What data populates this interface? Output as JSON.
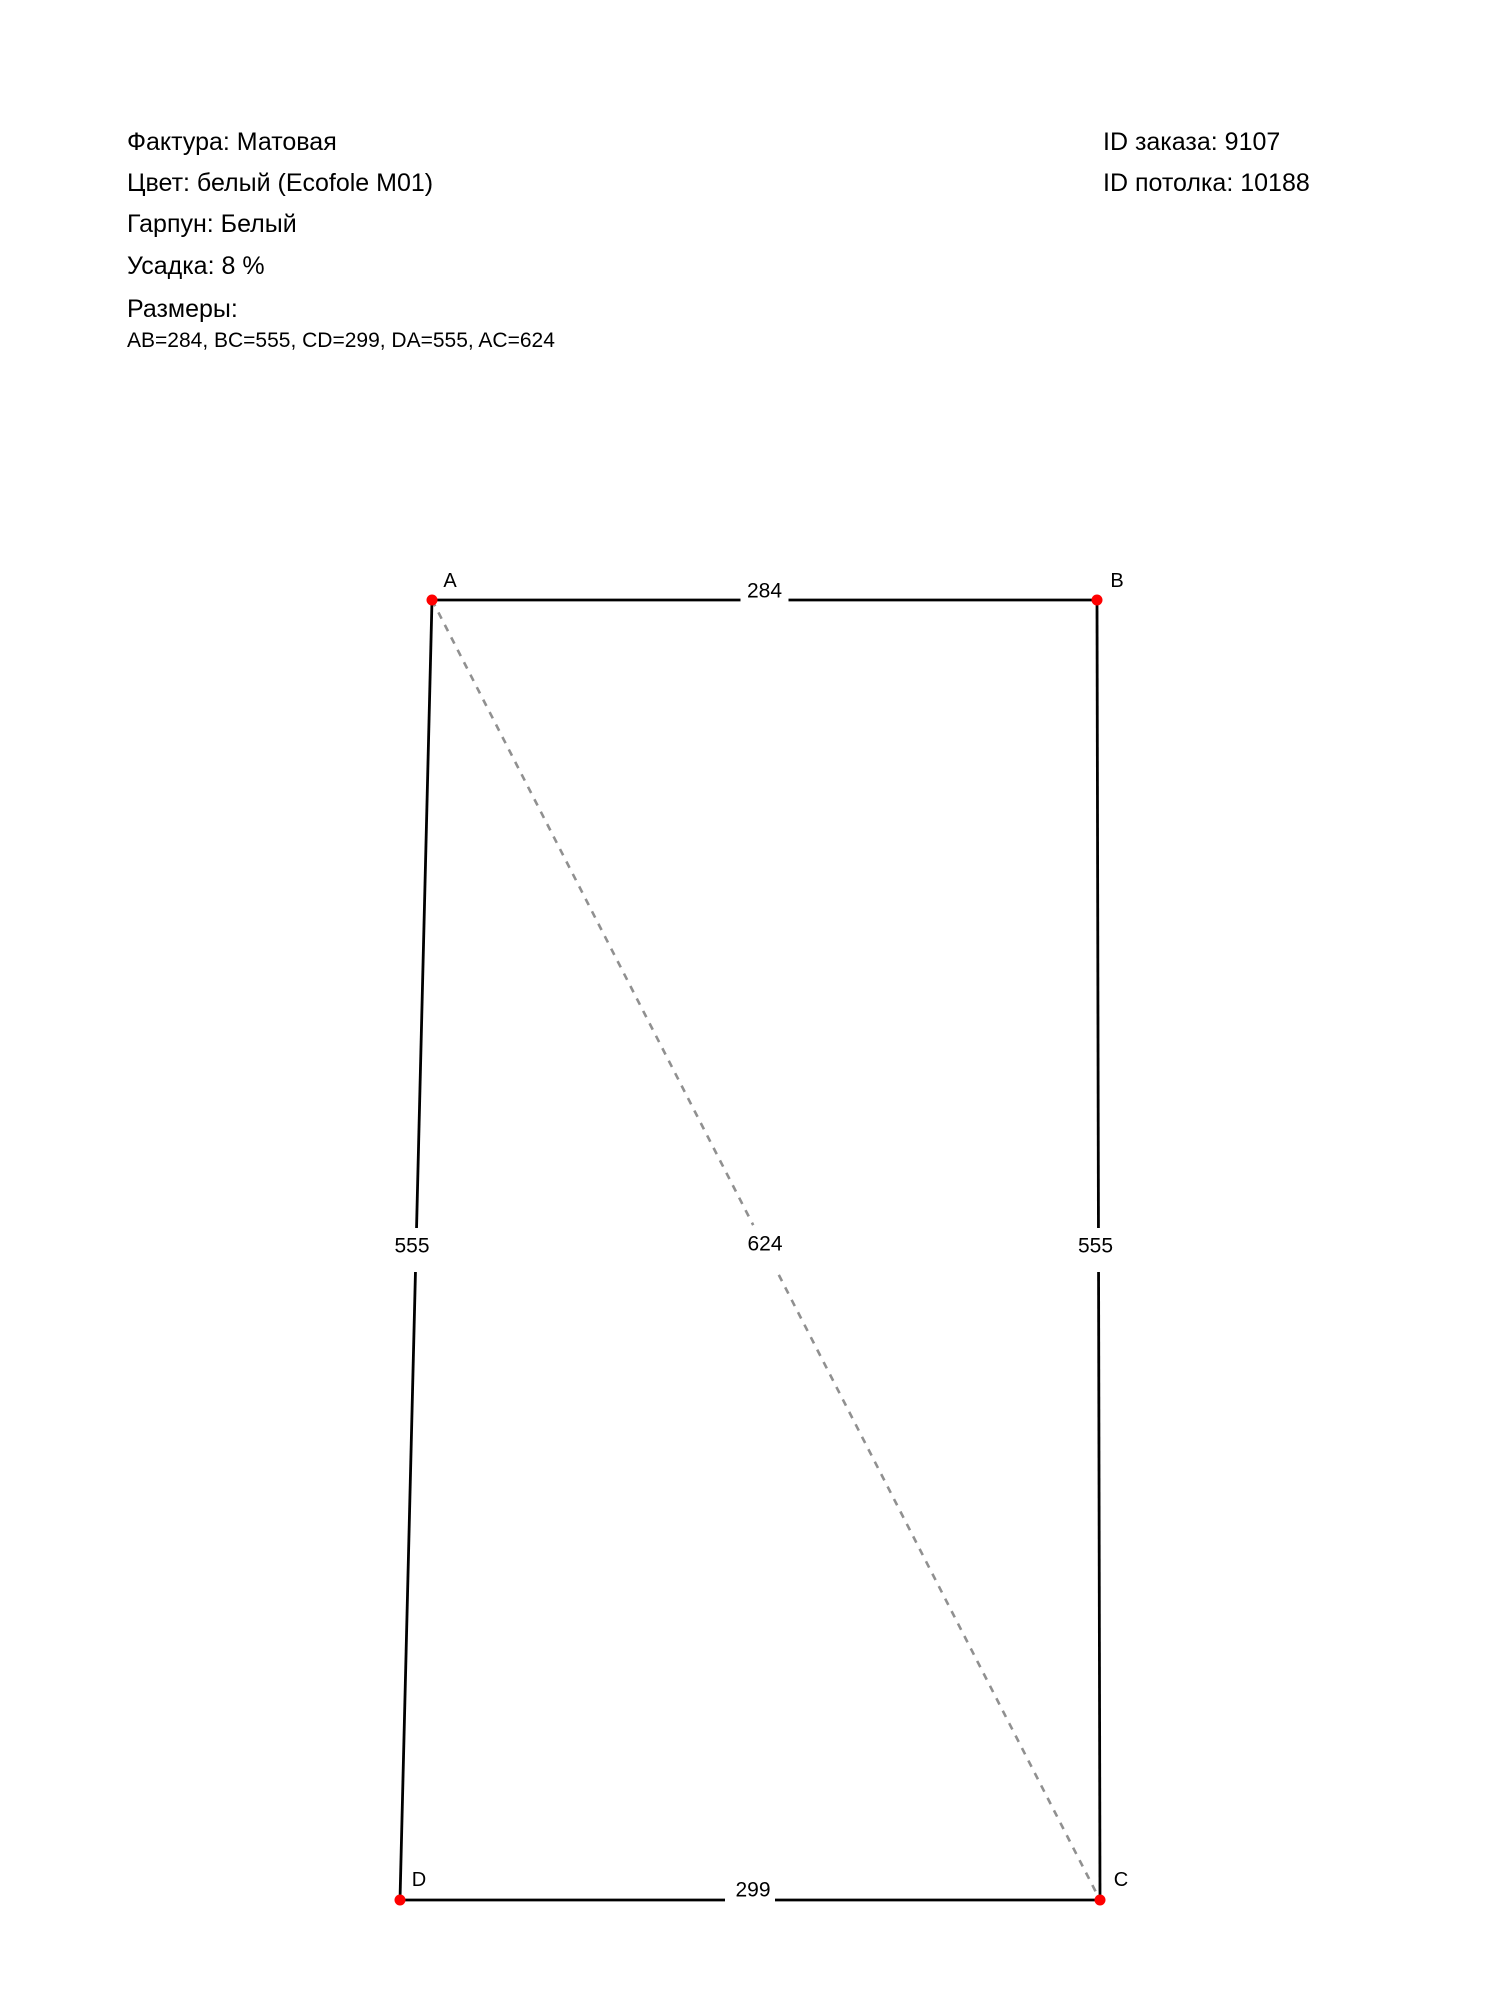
{
  "page": {
    "background": "#ffffff"
  },
  "order_info": {
    "texture": "Фактура: Матовая",
    "color": "Цвет: белый (Ecofole M01)",
    "harpoon": "Гарпун: Белый",
    "shrinkage": "Усадка: 8 %",
    "sizes_title": "Размеры:",
    "sizes_values": "AB=284, BC=555, CD=299, DA=555, AC=624",
    "order_id": "ID заказа: 9107",
    "ceiling_id": "ID потолка: 10188"
  },
  "diagram": {
    "colors": {
      "edge": "#000000",
      "diagonal": "#909090",
      "vertex_dot": "#ff0000",
      "label_text": "#000000"
    },
    "vertices": [
      {
        "name": "A",
        "x": 432,
        "y": 600,
        "label_dx": 18,
        "label_dy": -20
      },
      {
        "name": "B",
        "x": 1097,
        "y": 600,
        "label_dx": 20,
        "label_dy": -20
      },
      {
        "name": "C",
        "x": 1100,
        "y": 1900,
        "label_dx": 21,
        "label_dy": -21
      },
      {
        "name": "D",
        "x": 400,
        "y": 1900,
        "label_dx": 19,
        "label_dy": -21
      }
    ],
    "edges": [
      {
        "from": "A",
        "to": "B",
        "length": "284",
        "gap": 48,
        "label_dx": 0,
        "label_dy": -10
      },
      {
        "from": "B",
        "to": "C",
        "length": "555",
        "gap": 44,
        "label_dx": -3,
        "label_dy": -5
      },
      {
        "from": "C",
        "to": "D",
        "length": "299",
        "gap": 50,
        "label_dx": 3,
        "label_dy": -11
      },
      {
        "from": "D",
        "to": "A",
        "length": "555",
        "gap": 44,
        "label_dx": -4,
        "label_dy": -5
      }
    ],
    "diagonals": [
      {
        "from": "A",
        "to": "C",
        "length": "624",
        "gap": 56,
        "label_dx": -1,
        "label_dy": -7
      }
    ]
  }
}
